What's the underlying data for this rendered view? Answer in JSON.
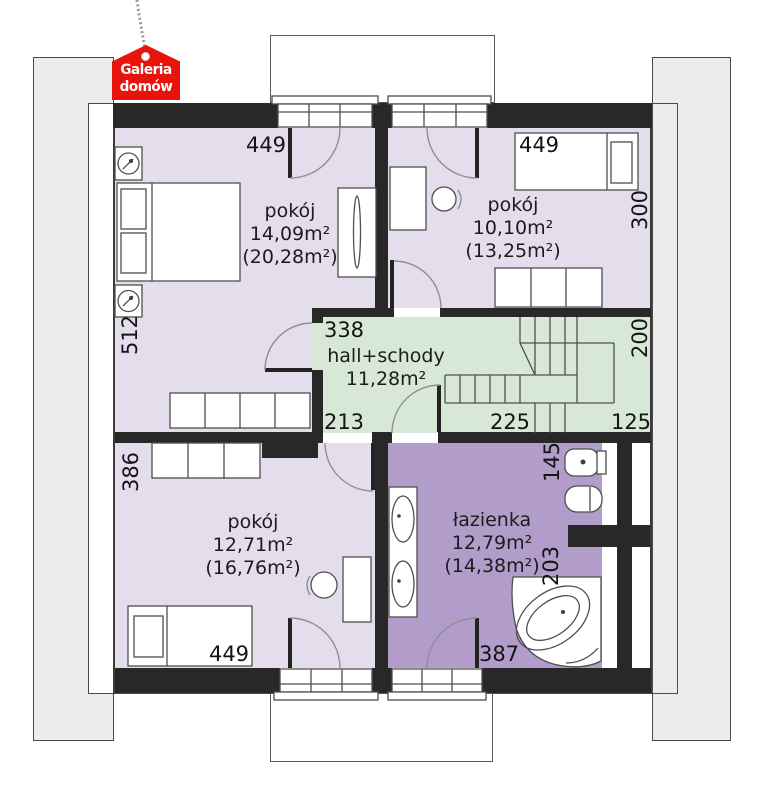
{
  "brand": {
    "line1": "Galeria",
    "line2": "domów"
  },
  "rooms": {
    "top_left": {
      "name": "pokój",
      "area": "14,09m²",
      "floor_area": "(20,28m²)"
    },
    "top_right": {
      "name": "pokój",
      "area": "10,10m²",
      "floor_area": "(13,25m²)"
    },
    "hall": {
      "name": "hall+schody",
      "area": "11,28m²"
    },
    "bottom_left": {
      "name": "pokój",
      "area": "12,71m²",
      "floor_area": "(16,76m²)"
    },
    "bathroom": {
      "name": "łazienka",
      "area": "12,79m²",
      "floor_area": "(14,38m²)"
    }
  },
  "dims": {
    "tl_width": "449",
    "tr_width": "449",
    "tr_height": "300",
    "tl_height": "512",
    "hall_top": "338",
    "hall_height": "200",
    "hall_left": "213",
    "hall_mid": "225",
    "hall_right": "125",
    "bl_height": "386",
    "bath_top": "145",
    "bath_mid": "203",
    "bath_width": "387",
    "bl_width": "449"
  },
  "colors": {
    "room": "#e4ddec",
    "bathroom": "#b29cc9",
    "hall": "#d8e8d6",
    "wall": "#282828",
    "eave": "#ececeb",
    "brand_red": "#e8140c"
  }
}
